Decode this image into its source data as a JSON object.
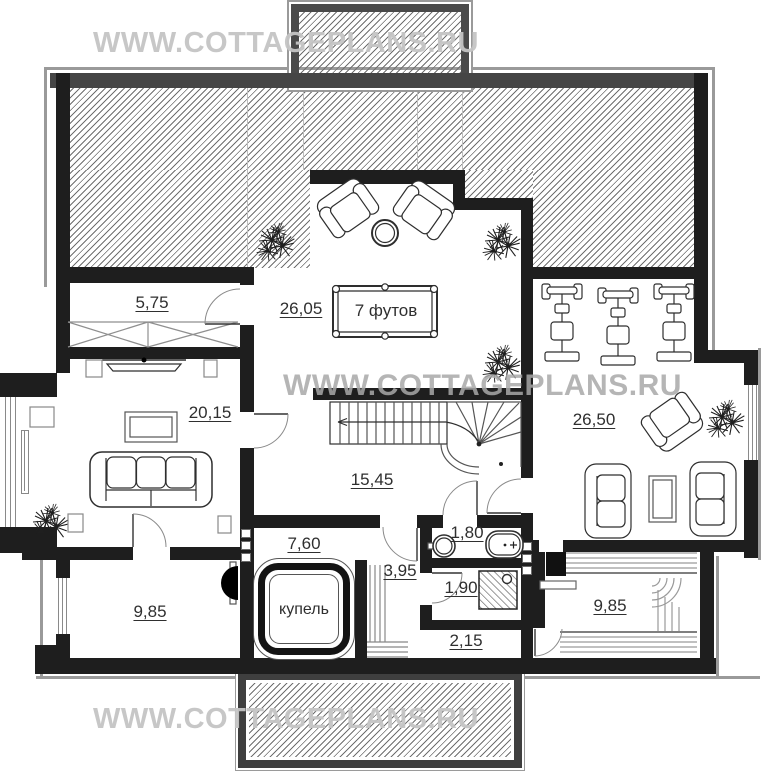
{
  "watermark": {
    "text": "WWW.COTTAGEPLANS.RU"
  },
  "rooms": {
    "wardrobe": "5,75",
    "living_room": "20,15",
    "billiard_room": "26,05",
    "billiard_table": "7 футов",
    "stair_hall": "15,45",
    "lounge": "26,50",
    "hall": "7,60",
    "plunge_pool": "купель",
    "steps": "3,95",
    "bathroom": "1,80",
    "shower_room": "1,90",
    "corridor": "2,15",
    "room_left": "9,85",
    "sauna": "9,85"
  },
  "colors": {
    "wall": "#1e1e1e",
    "roof_edge": "#4a4a4a",
    "hatch_line": "#6f6f6f",
    "label": "#2f2f2f",
    "watermark_light": "#c4c4c4",
    "watermark_mid": "#a8a8a8"
  }
}
